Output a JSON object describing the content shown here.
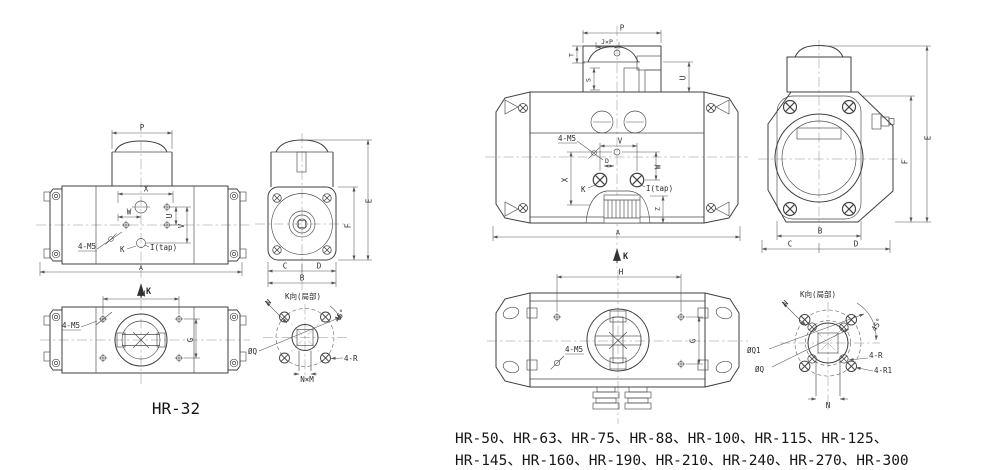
{
  "colors": {
    "background": "#ffffff",
    "line": "#3f3f3f",
    "dim": "#555555",
    "text": "#2b2b2b"
  },
  "captions": {
    "left_model": "HR-32",
    "series_line1": "HR-50、HR-63、HR-75、HR-88、HR-100、HR-115、HR-125、",
    "series_line2": "HR-145、HR-160、HR-190、HR-210、HR-240、HR-270、HR-300"
  },
  "left": {
    "front": {
      "p": "P",
      "x": "X",
      "w": "W",
      "u": "U",
      "v": "V",
      "m5": "4-M5",
      "k": "K",
      "tap": "I(tap)",
      "a": "A",
      "view_dir": "K"
    },
    "side": {
      "e": "E",
      "f": "F",
      "c": "C",
      "d": "D",
      "b": "B"
    },
    "bottom": {
      "h": "H",
      "g": "G",
      "m5": "4-M5"
    },
    "flange": {
      "title": "K向(局部)",
      "n": "N",
      "angle": "45°",
      "q": "ØQ",
      "r": "4-R",
      "nm": "N×M"
    }
  },
  "right": {
    "front": {
      "p": "P",
      "jp": "J×P",
      "t": "T",
      "s": "S",
      "u": "U",
      "v": "V",
      "d": "D",
      "x": "X",
      "w": "W",
      "m5": "4-M5",
      "k": "K",
      "tap": "I(tap)",
      "z": "Z",
      "a": "A",
      "view_dir": "K"
    },
    "side": {
      "e": "E",
      "f": "F",
      "b": "B",
      "c": "C",
      "d": "D"
    },
    "bottom": {
      "h": "H",
      "g": "G",
      "m5": "4-M5"
    },
    "flange": {
      "title": "K向(局部)",
      "n": "N",
      "angle": "45°",
      "q1": "ØQ1",
      "q": "ØQ",
      "r": "4-R",
      "r1": "4-R1",
      "n2": "N"
    }
  }
}
